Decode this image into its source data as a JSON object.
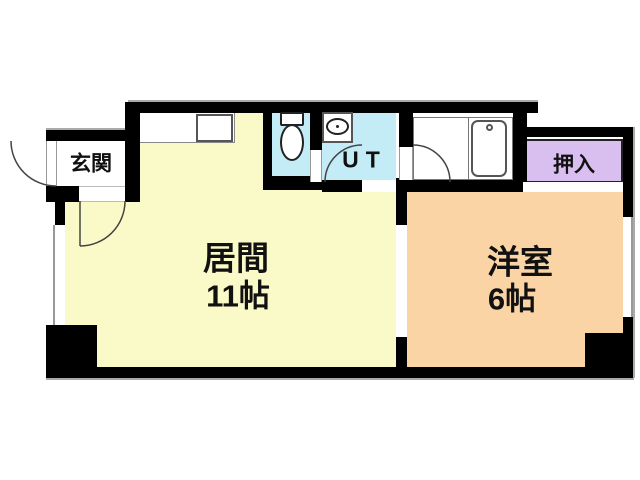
{
  "plan_type": "apartment-floor-plan",
  "rooms": {
    "genkan": {
      "label": "玄関"
    },
    "living": {
      "label": "居間",
      "size": "11帖"
    },
    "ut": {
      "label": "UT"
    },
    "western": {
      "label": "洋室",
      "size": "6帖"
    },
    "oshiire": {
      "label": "押入"
    }
  },
  "colors": {
    "living_floor": "#FAFAC8",
    "water_area_floor": "#C4ECF6",
    "western_floor": "#FBD4A6",
    "closet_floor": "#D9BEF0",
    "wall": "#000000",
    "fixture_outline": "#555555",
    "door_arc": "#444444",
    "hairline": "#aaaaaa"
  }
}
